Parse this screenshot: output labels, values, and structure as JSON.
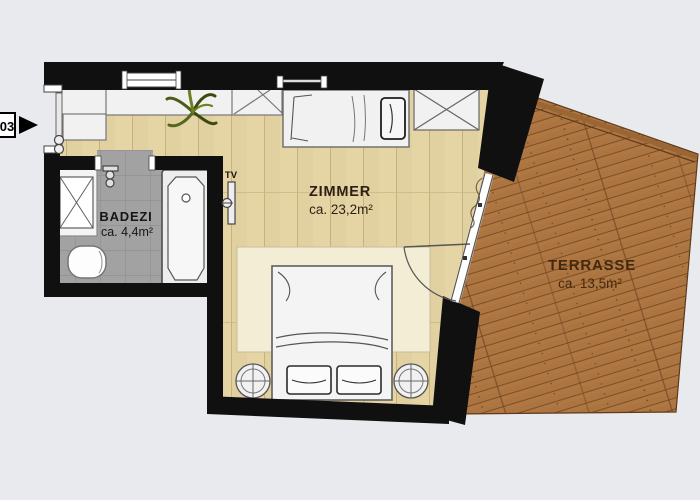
{
  "unit": {
    "number": "03"
  },
  "rooms": {
    "zimmer": {
      "name": "ZIMMER",
      "area": "ca. 23,2m²"
    },
    "badezimmer": {
      "name": "BADEZI",
      "area": "ca. 4,4m²"
    },
    "terrasse": {
      "name": "TERRASSE",
      "area": "ca. 13,5m²"
    }
  },
  "fixtures": {
    "tv_label": "TV"
  },
  "icons": {
    "entrance_arrow": "black triangle pointing right at entry door",
    "plant": "green plant in hall corner",
    "shower": "square with X",
    "toilet": "pill shape",
    "bathtub": "rectangle with inner tub and drain",
    "double_bed": "bed with two pillows and round nightstands",
    "single_bed": "bed with pillow along top wall",
    "wardrobe": "rectangle with X",
    "tv_mount": "wall bracket with TV"
  },
  "colors": {
    "background": "#e9eaed",
    "wall": "#101010",
    "room_floor": "#e6d5a4",
    "bath_tile": "#a2a2a2",
    "terrace_wood": "#ab7440",
    "rug": "#f3edd5",
    "label_text": "#2b1f14",
    "terrace_text": "#45290e"
  }
}
